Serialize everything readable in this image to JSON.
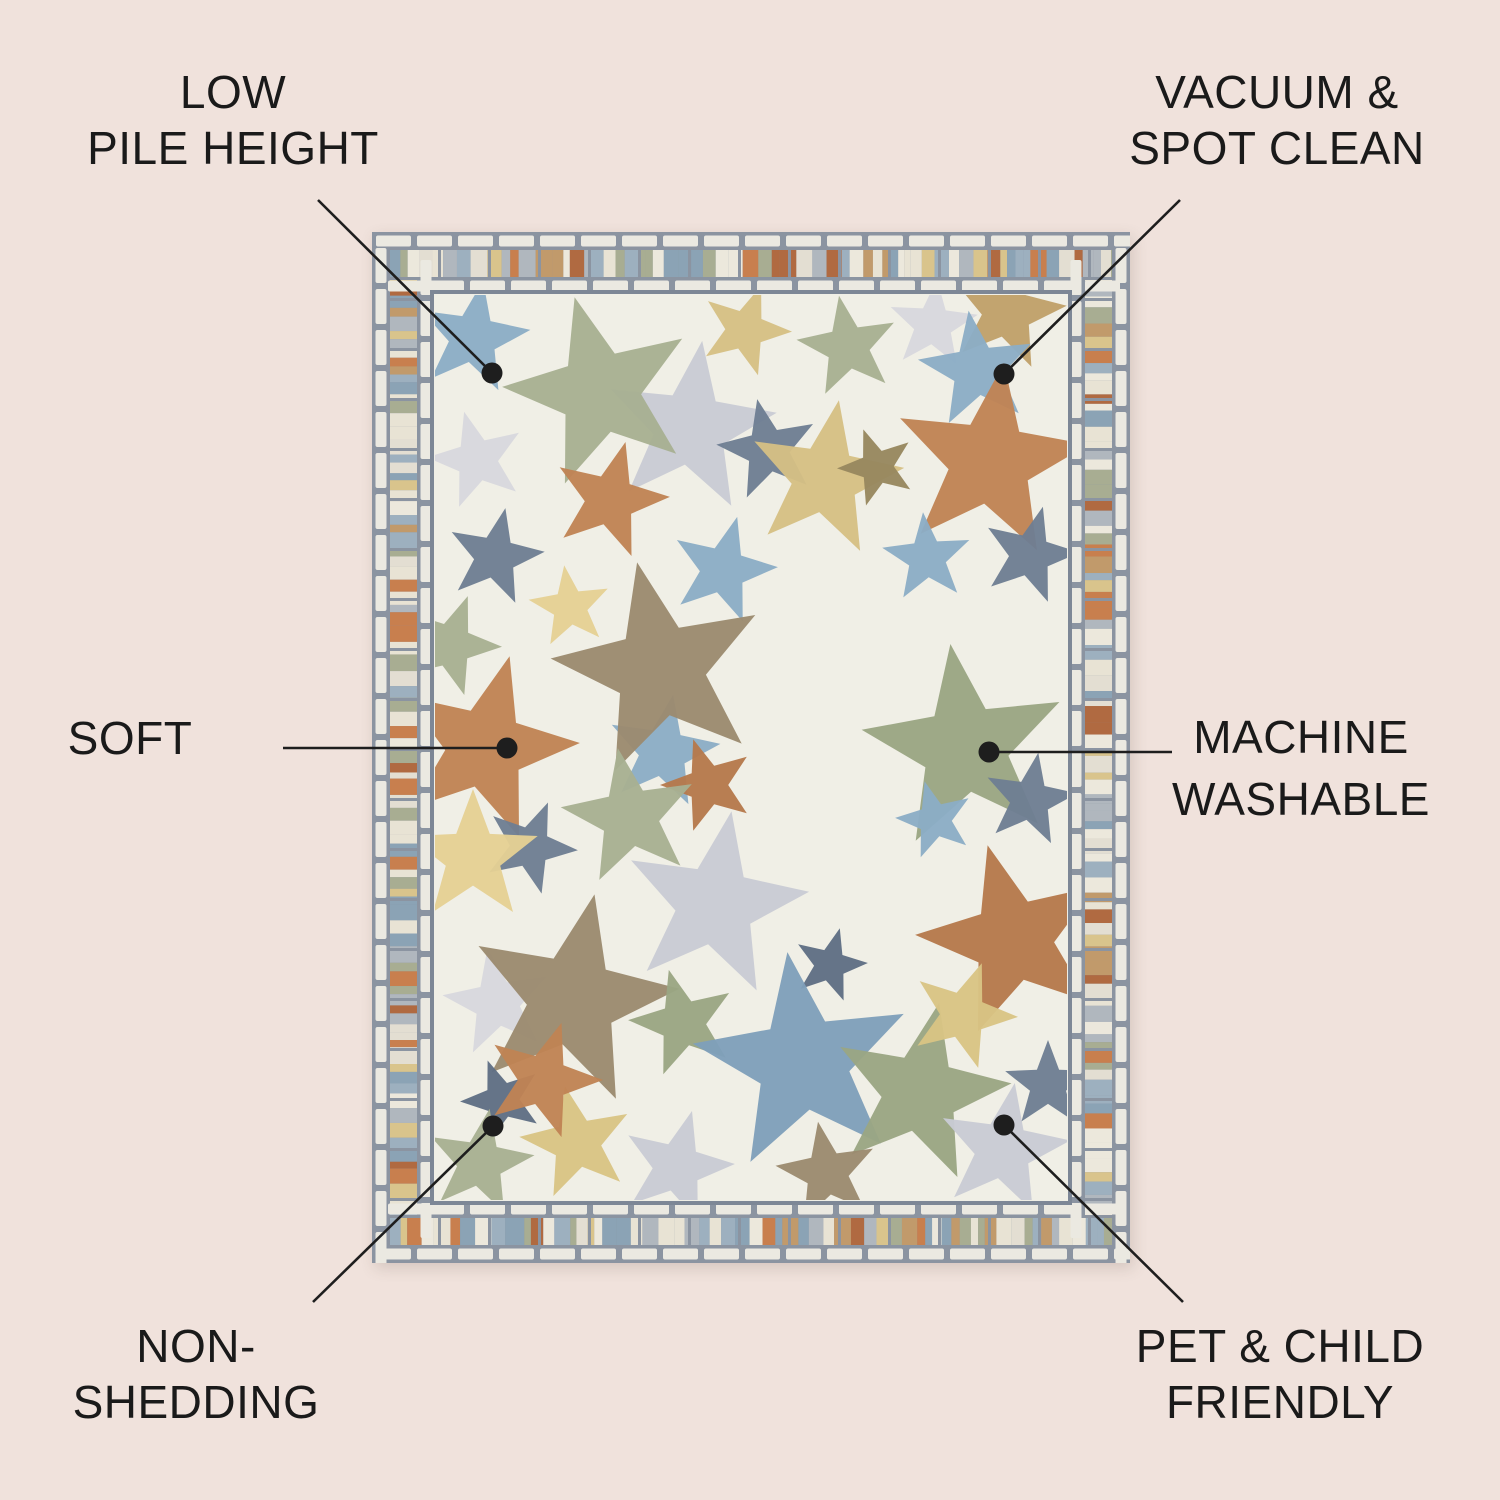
{
  "page": {
    "background": "#f0e2dc",
    "text_color": "#1a1a1a",
    "line_color": "#1e1e1e"
  },
  "callouts": [
    {
      "id": "low-pile-height",
      "lines": [
        "LOW",
        "PILE HEIGHT"
      ],
      "dot": [
        492,
        373
      ],
      "line_from": [
        318,
        200
      ]
    },
    {
      "id": "vacuum-spot-clean",
      "lines": [
        "VACUUM &",
        "SPOT CLEAN"
      ],
      "dot": [
        1004,
        374
      ],
      "line_from": [
        1180,
        200
      ]
    },
    {
      "id": "soft",
      "lines": [
        "SOFT"
      ],
      "dot": [
        507,
        748
      ],
      "line_from": [
        283,
        748
      ]
    },
    {
      "id": "machine-washable",
      "lines": [
        "MACHINE",
        "WASHABLE"
      ],
      "dot": [
        989,
        752
      ],
      "line_from": [
        1172,
        752
      ]
    },
    {
      "id": "non-shedding",
      "lines": [
        "NON-",
        "SHEDDING"
      ],
      "dot": [
        493,
        1126
      ],
      "line_from": [
        313,
        1302
      ]
    },
    {
      "id": "pet-child-friendly",
      "lines": [
        "PET & CHILD",
        "FRIENDLY"
      ],
      "dot": [
        1004,
        1125
      ],
      "line_from": [
        1183,
        1302
      ]
    }
  ],
  "rug": {
    "x": 372,
    "y": 232,
    "width": 758,
    "height": 1031,
    "field_color": "#f0efe6",
    "slate": "#8b94a1",
    "frame_slate": "#7d8796",
    "brick_fill": "#ebe9e1",
    "stripe_palette": [
      "#e3ded2",
      "#c19a6b",
      "#b06a41",
      "#9db0bf",
      "#d9c48c",
      "#b0b7be",
      "#a8ad92",
      "#ece8dc",
      "#8ba3b5",
      "#c87f4e",
      "#e8e3d4"
    ],
    "star_colors": {
      "sage": "#a8b092",
      "sage2": "#9aa683",
      "gray": "#c9cbd4",
      "palegray": "#d7d7de",
      "blue": "#8badc6",
      "blue2": "#7f9fba",
      "slate": "#6e7e93",
      "slate2": "#5f6e84",
      "rust": "#bf8354",
      "rust2": "#b5794c",
      "tan": "#bfa06a",
      "khaki": "#d5c084",
      "khaki2": "#d9c484",
      "olive": "#97875f",
      "taupe": "#9b8a6f",
      "paleyellow": "#e5d094"
    },
    "stars": [
      [
        473,
        338,
        58,
        10,
        "blue"
      ],
      [
        690,
        428,
        88,
        8,
        "gray"
      ],
      [
        600,
        392,
        98,
        -15,
        "sage"
      ],
      [
        745,
        330,
        47,
        20,
        "khaki"
      ],
      [
        848,
        347,
        52,
        -10,
        "sage"
      ],
      [
        933,
        325,
        46,
        5,
        "palegray"
      ],
      [
        1007,
        312,
        60,
        12,
        "tan"
      ],
      [
        977,
        370,
        60,
        -8,
        "blue"
      ],
      [
        477,
        460,
        50,
        -15,
        "palegray"
      ],
      [
        610,
        500,
        60,
        15,
        "rust"
      ],
      [
        768,
        450,
        52,
        -12,
        "slate"
      ],
      [
        825,
        479,
        80,
        10,
        "khaki"
      ],
      [
        877,
        467,
        40,
        -20,
        "olive"
      ],
      [
        990,
        462,
        100,
        8,
        "rust"
      ],
      [
        495,
        557,
        50,
        12,
        "slate"
      ],
      [
        570,
        607,
        42,
        -8,
        "paleyellow"
      ],
      [
        723,
        570,
        55,
        15,
        "blue"
      ],
      [
        663,
        752,
        58,
        10,
        "blue"
      ],
      [
        927,
        558,
        46,
        -5,
        "blue"
      ],
      [
        1030,
        555,
        50,
        15,
        "slate"
      ],
      [
        450,
        645,
        52,
        20,
        "sage"
      ],
      [
        660,
        670,
        110,
        -12,
        "taupe"
      ],
      [
        485,
        748,
        95,
        15,
        "rust"
      ],
      [
        965,
        748,
        105,
        -8,
        "sage2"
      ],
      [
        1030,
        800,
        48,
        10,
        "slate"
      ],
      [
        935,
        820,
        40,
        -15,
        "blue"
      ],
      [
        708,
        785,
        48,
        -18,
        "rust2"
      ],
      [
        630,
        817,
        70,
        -10,
        "sage"
      ],
      [
        530,
        847,
        48,
        22,
        "slate"
      ],
      [
        473,
        857,
        68,
        0,
        "paleyellow"
      ],
      [
        715,
        905,
        95,
        10,
        "gray"
      ],
      [
        497,
        1003,
        55,
        -10,
        "palegray"
      ],
      [
        572,
        1000,
        108,
        12,
        "taupe"
      ],
      [
        683,
        1023,
        55,
        -15,
        "sage2"
      ],
      [
        830,
        965,
        38,
        15,
        "slate2"
      ],
      [
        803,
        1063,
        112,
        -8,
        "blue2"
      ],
      [
        920,
        1093,
        92,
        12,
        "sage2"
      ],
      [
        1013,
        940,
        98,
        -15,
        "rust2"
      ],
      [
        963,
        1015,
        55,
        20,
        "khaki2"
      ],
      [
        1003,
        1150,
        68,
        10,
        "gray"
      ],
      [
        827,
        1173,
        52,
        -10,
        "taupe"
      ],
      [
        677,
        1167,
        58,
        15,
        "gray"
      ],
      [
        502,
        1100,
        42,
        -20,
        "slate2"
      ],
      [
        480,
        1163,
        55,
        10,
        "sage"
      ],
      [
        577,
        1143,
        58,
        -12,
        "khaki2"
      ],
      [
        543,
        1080,
        60,
        18,
        "rust"
      ],
      [
        1048,
        1085,
        45,
        0,
        "slate"
      ]
    ]
  }
}
